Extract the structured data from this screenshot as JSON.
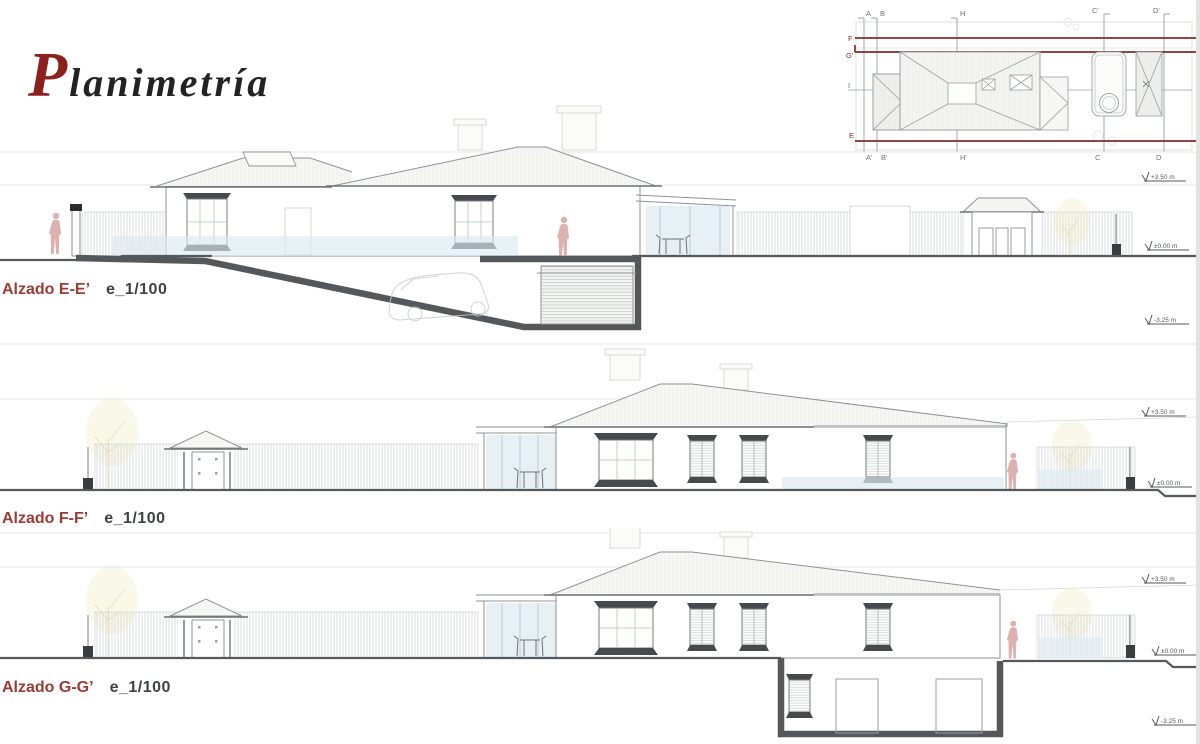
{
  "title": {
    "initial": "P",
    "rest": "lanimetría"
  },
  "key_plan": {
    "top_labels": [
      "A",
      "B",
      "H",
      "C'",
      "D'"
    ],
    "bottom_labels": [
      "A'",
      "B'",
      "H'",
      "C",
      "D"
    ],
    "left_labels": [
      "F",
      "G'",
      "I",
      "E"
    ]
  },
  "elevations": [
    {
      "name": "Alzado E-E’",
      "scale": "e_1/100",
      "levels": [
        "+3.50 m",
        "±0.00 m",
        "-3.25 m"
      ]
    },
    {
      "name": "Alzado F-F’",
      "scale": "e_1/100",
      "levels": [
        "+3.50 m",
        "±0.00 m"
      ]
    },
    {
      "name": "Alzado G-G’",
      "scale": "e_1/100",
      "levels": [
        "+3.50 m",
        "±0.00 m",
        "-3.25 m"
      ]
    }
  ],
  "colors": {
    "title_initial_red": "#8e201c",
    "label_red": "#9c3b33",
    "scale_text_gray": "#3f4244",
    "section_line_red": "#7f2d2a",
    "drawing_gray": "#8f9396",
    "heavy_wall_gray": "#54585b",
    "glass_blue": "#dce9f1",
    "person_pink": "#ddb1ae",
    "foliage_yellow": "#efeabc"
  }
}
